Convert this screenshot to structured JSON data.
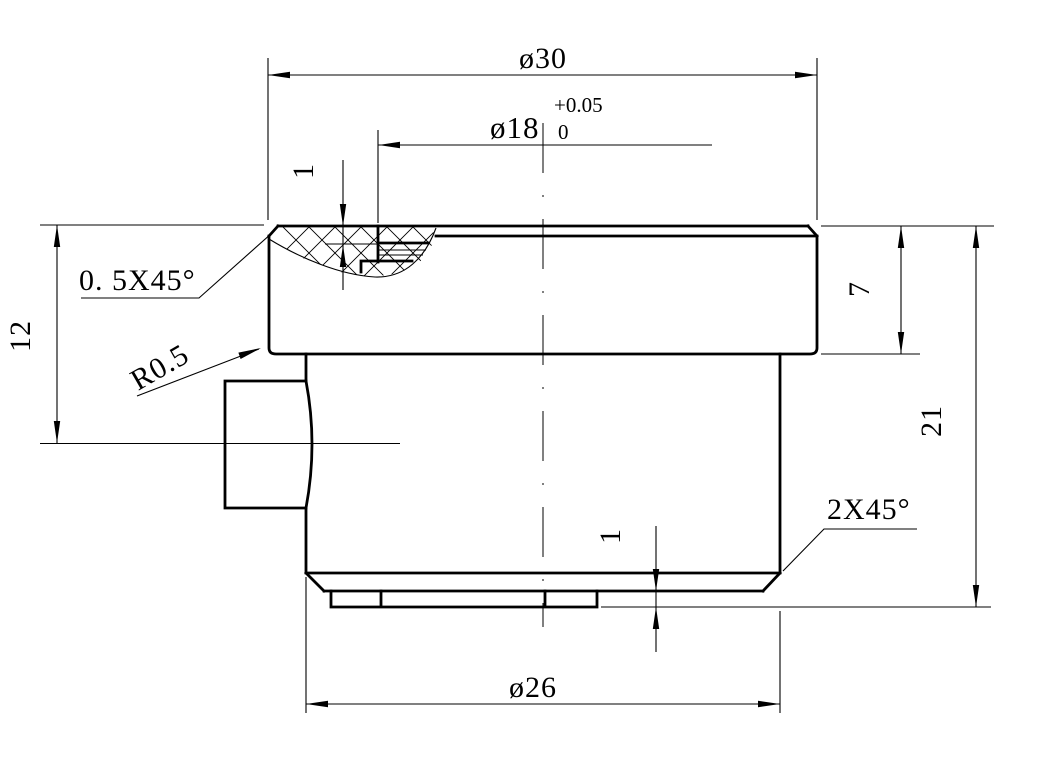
{
  "drawing": {
    "kind": "engineering-section-view",
    "background_color": "#ffffff",
    "line_color": "#000000",
    "labels": {
      "dia_flange": "ø30",
      "dia_bore": "ø18",
      "dia_bore_tol_upper": "+0.05",
      "dia_bore_tol_lower": "0",
      "counterbore_depth": "1",
      "chamfer_top": "0. 5X45°",
      "fillet_radius": "R0.5",
      "boss_center_from_top": "12",
      "flange_thickness": "7",
      "overall_height": "21",
      "chamfer_bottom": "2X45°",
      "lip_height": "1",
      "dia_body": "ø26"
    }
  }
}
